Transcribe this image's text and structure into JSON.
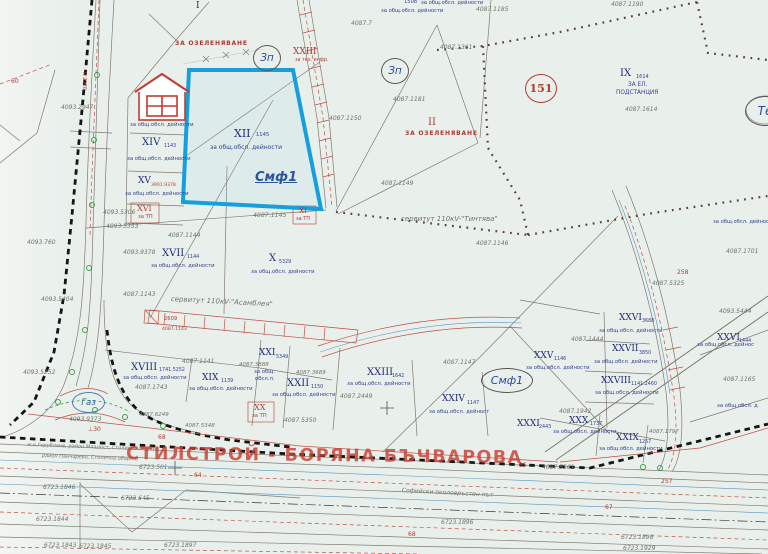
{
  "watermark": "СТИЛСТРОЙ - БОРЯНА БЪЧВАРОВА",
  "zones": {
    "zp1": "Зп",
    "zp2": "Зп",
    "circle151": "151",
    "te": "Те",
    "gas": "Газ",
    "smf1": "Смф1"
  },
  "labels": [
    {
      "t": "I",
      "x": 196,
      "y": 2,
      "c": "br",
      "fs": 9
    },
    {
      "t": "ЗА ОЗЕЛЕНЯВАНЕ",
      "x": 175,
      "y": 41,
      "c": "ri",
      "fs": 6
    },
    {
      "t": "XXIII",
      "x": 293,
      "y": 48,
      "c": "r",
      "fs": 9
    },
    {
      "t": "за тех. инфр.",
      "x": 295,
      "y": 59,
      "c": "rs",
      "fs": 4.8
    },
    {
      "t": "4087.1190",
      "x": 611,
      "y": 2,
      "c": "g",
      "fs": 6
    },
    {
      "t": "1508",
      "x": 404,
      "y": 0,
      "c": "b",
      "fs": 5.2
    },
    {
      "t": "за общ.обсл. дейности",
      "x": 421,
      "y": 1,
      "c": "b",
      "fs": 5.2
    },
    {
      "t": "за общ.обсл. дейности",
      "x": 381,
      "y": 9,
      "c": "b",
      "fs": 5.2
    },
    {
      "t": "4087.1185",
      "x": 476,
      "y": 7,
      "c": "g",
      "fs": 6
    },
    {
      "t": "4087.7",
      "x": 351,
      "y": 21,
      "c": "g",
      "fs": 6
    },
    {
      "t": "4087.1361",
      "x": 440,
      "y": 45,
      "c": "g",
      "fs": 6
    },
    {
      "t": "4087.1181",
      "x": 393,
      "y": 97,
      "c": "g",
      "fs": 6
    },
    {
      "t": "4087.1150",
      "x": 329,
      "y": 116,
      "c": "g",
      "fs": 6
    },
    {
      "t": "4087.1149",
      "x": 381,
      "y": 181,
      "c": "g",
      "fs": 6
    },
    {
      "t": "II",
      "x": 428,
      "y": 118,
      "c": "r",
      "fs": 10
    },
    {
      "t": "ЗА ОЗЕЛЕНЯВАНЕ",
      "x": 405,
      "y": 131,
      "c": "ri",
      "fs": 6
    },
    {
      "t": "IX",
      "x": 620,
      "y": 69,
      "c": "br",
      "fs": 10
    },
    {
      "t": "1614",
      "x": 636,
      "y": 75,
      "c": "bs",
      "fs": 5
    },
    {
      "t": "ЗА ЕЛ.",
      "x": 628,
      "y": 83,
      "c": "b",
      "fs": 5.8
    },
    {
      "t": "ПОДСТАНЦИЯ",
      "x": 616,
      "y": 91,
      "c": "b",
      "fs": 5.8
    },
    {
      "t": "4087.1614",
      "x": 625,
      "y": 107,
      "c": "g",
      "fs": 6
    },
    {
      "t": "за общ.обсл. дейности",
      "x": 130,
      "y": 123,
      "c": "b",
      "fs": 5.3
    },
    {
      "t": "XIV",
      "x": 142,
      "y": 138,
      "c": "br",
      "fs": 10
    },
    {
      "t": "1143",
      "x": 164,
      "y": 145,
      "c": "bs",
      "fs": 4.8
    },
    {
      "t": "за общ.обсл. дейности",
      "x": 127,
      "y": 157,
      "c": "b",
      "fs": 5.3
    },
    {
      "t": "XV",
      "x": 138,
      "y": 177,
      "c": "br",
      "fs": 9
    },
    {
      "t": "3901.9378",
      "x": 151,
      "y": 184,
      "c": "rs",
      "fs": 4.6
    },
    {
      "t": "за общ.обсл. дейности",
      "x": 125,
      "y": 192,
      "c": "b",
      "fs": 5.3
    },
    {
      "t": "XVI",
      "x": 137,
      "y": 205,
      "c": "r",
      "fs": 8
    },
    {
      "t": "за ТП",
      "x": 138,
      "y": 215,
      "c": "rs",
      "fs": 5.2
    },
    {
      "t": "4093.2947",
      "x": 61,
      "y": 105,
      "c": "g",
      "fs": 6
    },
    {
      "t": "R 2000",
      "x": 86,
      "y": 72,
      "c": "rs",
      "fs": 5,
      "rot": 90
    },
    {
      "t": "60",
      "x": 11,
      "y": 79,
      "c": "rs",
      "fs": 6
    },
    {
      "t": "4093.760",
      "x": 27,
      "y": 240,
      "c": "g",
      "fs": 6
    },
    {
      "t": "4093.5306",
      "x": 103,
      "y": 210,
      "c": "g",
      "fs": 6
    },
    {
      "t": "4093.5353",
      "x": 106,
      "y": 224,
      "c": "g",
      "fs": 6
    },
    {
      "t": "4093.9378",
      "x": 123,
      "y": 250,
      "c": "g",
      "fs": 6
    },
    {
      "t": "4093.5404",
      "x": 41,
      "y": 297,
      "c": "g",
      "fs": 6
    },
    {
      "t": "4093.5252",
      "x": 23,
      "y": 370,
      "c": "g",
      "fs": 6
    },
    {
      "t": "4093.9373",
      "x": 69,
      "y": 417,
      "c": "g",
      "fs": 6
    },
    {
      "t": "XII",
      "x": 234,
      "y": 128,
      "c": "br",
      "fs": 11
    },
    {
      "t": "1145",
      "x": 256,
      "y": 133,
      "c": "bs",
      "fs": 5.2
    },
    {
      "t": "за общ.обсл. дейности",
      "x": 210,
      "y": 145,
      "c": "b",
      "fs": 6
    },
    {
      "t": "Смф1",
      "x": 255,
      "y": 171,
      "c": "zb",
      "fs": 13
    },
    {
      "t": "4087.1145",
      "x": 253,
      "y": 213,
      "c": "g",
      "fs": 6.2
    },
    {
      "t": "XI",
      "x": 299,
      "y": 208,
      "c": "r",
      "fs": 7
    },
    {
      "t": "за ТП",
      "x": 296,
      "y": 217,
      "c": "rs",
      "fs": 5
    },
    {
      "t": "4087.1144",
      "x": 168,
      "y": 233,
      "c": "g",
      "fs": 6
    },
    {
      "t": "XVII",
      "x": 162,
      "y": 249,
      "c": "br",
      "fs": 10
    },
    {
      "t": "1144",
      "x": 187,
      "y": 256,
      "c": "bs",
      "fs": 4.8
    },
    {
      "t": "за общ.обсл. дейности",
      "x": 151,
      "y": 264,
      "c": "b",
      "fs": 5.3
    },
    {
      "t": "X",
      "x": 269,
      "y": 254,
      "c": "br",
      "fs": 10
    },
    {
      "t": "5329",
      "x": 279,
      "y": 261,
      "c": "bs",
      "fs": 4.8
    },
    {
      "t": "за общ.обсл. дейности",
      "x": 251,
      "y": 270,
      "c": "b",
      "fs": 5.3
    },
    {
      "t": "4087.1143",
      "x": 123,
      "y": 292,
      "c": "g",
      "fs": 6
    },
    {
      "t": "сервитут 110кV-\"Тинтява\"",
      "x": 401,
      "y": 216,
      "c": "gi",
      "fs": 7
    },
    {
      "t": "4087.1146",
      "x": 476,
      "y": 241,
      "c": "g",
      "fs": 6
    },
    {
      "t": "сервитут 110кV-\"Асамблея\"",
      "x": 171,
      "y": 296,
      "c": "gi",
      "fs": 7,
      "rot": 3
    },
    {
      "t": "2609",
      "x": 164,
      "y": 317,
      "c": "rs",
      "fs": 5.2
    },
    {
      "t": "4087.1143",
      "x": 162,
      "y": 328,
      "c": "rs",
      "fs": 4.6
    },
    {
      "t": "за общ.обсл. дейност",
      "x": 713,
      "y": 220,
      "c": "b",
      "fs": 5.2
    },
    {
      "t": "4087.1701",
      "x": 726,
      "y": 249,
      "c": "g",
      "fs": 6
    },
    {
      "t": "XVIII",
      "x": 131,
      "y": 363,
      "c": "br",
      "fs": 10
    },
    {
      "t": "1741.5252",
      "x": 159,
      "y": 369,
      "c": "bs",
      "fs": 4.8
    },
    {
      "t": "за общ.обсл. дейности",
      "x": 123,
      "y": 376,
      "c": "b",
      "fs": 5.3
    },
    {
      "t": "4087.1743",
      "x": 135,
      "y": 385,
      "c": "g",
      "fs": 6
    },
    {
      "t": "4087.1141",
      "x": 182,
      "y": 359,
      "c": "g",
      "fs": 6
    },
    {
      "t": "XIX",
      "x": 202,
      "y": 374,
      "c": "br",
      "fs": 9
    },
    {
      "t": "1139",
      "x": 221,
      "y": 380,
      "c": "bs",
      "fs": 4.8
    },
    {
      "t": "за общ.обсл. дейности",
      "x": 189,
      "y": 387,
      "c": "b",
      "fs": 5.3
    },
    {
      "t": "XXI",
      "x": 259,
      "y": 349,
      "c": "br",
      "fs": 9
    },
    {
      "t": "5349",
      "x": 276,
      "y": 356,
      "c": "bs",
      "fs": 4.8
    },
    {
      "t": "4087.3888",
      "x": 239,
      "y": 363,
      "c": "g",
      "fs": 5.5
    },
    {
      "t": "за общ.",
      "x": 254,
      "y": 370,
      "c": "b",
      "fs": 5.3
    },
    {
      "t": "обсл.п.",
      "x": 255,
      "y": 377,
      "c": "b",
      "fs": 5.3
    },
    {
      "t": "XX",
      "x": 254,
      "y": 404,
      "c": "r",
      "fs": 8
    },
    {
      "t": "за ТП",
      "x": 252,
      "y": 414,
      "c": "rs",
      "fs": 5.2
    },
    {
      "t": "4087.5350",
      "x": 284,
      "y": 418,
      "c": "g",
      "fs": 6
    },
    {
      "t": "4087.3689",
      "x": 296,
      "y": 371,
      "c": "g",
      "fs": 5.5
    },
    {
      "t": "XXII",
      "x": 287,
      "y": 379,
      "c": "br",
      "fs": 10
    },
    {
      "t": "1150",
      "x": 311,
      "y": 386,
      "c": "bs",
      "fs": 4.8
    },
    {
      "t": "за общ.обсл. дейности",
      "x": 272,
      "y": 393,
      "c": "b",
      "fs": 5.3
    },
    {
      "t": "XXIII",
      "x": 367,
      "y": 368,
      "c": "br",
      "fs": 10
    },
    {
      "t": "1642",
      "x": 392,
      "y": 375,
      "c": "bs",
      "fs": 4.8
    },
    {
      "t": "за общ.обсл. дейности",
      "x": 347,
      "y": 382,
      "c": "b",
      "fs": 5.3
    },
    {
      "t": "4087.2449",
      "x": 340,
      "y": 394,
      "c": "g",
      "fs": 6
    },
    {
      "t": "4087.1147",
      "x": 443,
      "y": 360,
      "c": "g",
      "fs": 6
    },
    {
      "t": "XXIV",
      "x": 442,
      "y": 395,
      "c": "br",
      "fs": 9
    },
    {
      "t": "1147",
      "x": 467,
      "y": 402,
      "c": "bs",
      "fs": 4.8
    },
    {
      "t": "за общ.обсл. дейност",
      "x": 429,
      "y": 410,
      "c": "b",
      "fs": 5.3
    },
    {
      "t": "4087.5325",
      "x": 652,
      "y": 281,
      "c": "g",
      "fs": 6
    },
    {
      "t": "258",
      "x": 677,
      "y": 270,
      "c": "rs",
      "fs": 6
    },
    {
      "t": "4093.5444",
      "x": 719,
      "y": 309,
      "c": "g",
      "fs": 6
    },
    {
      "t": "XXVI",
      "x": 619,
      "y": 314,
      "c": "br",
      "fs": 9
    },
    {
      "t": "3688",
      "x": 642,
      "y": 320,
      "c": "bs",
      "fs": 4.8
    },
    {
      "t": "за общ.обсл. дейности",
      "x": 599,
      "y": 329,
      "c": "b",
      "fs": 5.3
    },
    {
      "t": "4087.1444",
      "x": 571,
      "y": 337,
      "c": "g",
      "fs": 6
    },
    {
      "t": "XXVII",
      "x": 612,
      "y": 345,
      "c": "br",
      "fs": 9
    },
    {
      "t": "3850",
      "x": 639,
      "y": 352,
      "c": "bs",
      "fs": 4.8
    },
    {
      "t": "за общ.обсл. дейности",
      "x": 594,
      "y": 360,
      "c": "b",
      "fs": 5.3
    },
    {
      "t": "XXVIII",
      "x": 601,
      "y": 377,
      "c": "br",
      "fs": 9
    },
    {
      "t": "1141.2460",
      "x": 631,
      "y": 383,
      "c": "bs",
      "fs": 4.8
    },
    {
      "t": "за общ.обсл. дейности",
      "x": 595,
      "y": 391,
      "c": "b",
      "fs": 5.3
    },
    {
      "t": "XXV",
      "x": 534,
      "y": 352,
      "c": "br",
      "fs": 9
    },
    {
      "t": "1146",
      "x": 554,
      "y": 358,
      "c": "bs",
      "fs": 4.8
    },
    {
      "t": "за общ.обсл. дейности",
      "x": 526,
      "y": 366,
      "c": "b",
      "fs": 5.3
    },
    {
      "t": "XXVI",
      "x": 717,
      "y": 334,
      "c": "br",
      "fs": 9
    },
    {
      "t": "1444",
      "x": 739,
      "y": 340,
      "c": "bs",
      "fs": 4.8
    },
    {
      "t": "за общ.обсл. дейнос",
      "x": 697,
      "y": 343,
      "c": "b",
      "fs": 5.3
    },
    {
      "t": "4087.1165",
      "x": 723,
      "y": 377,
      "c": "g",
      "fs": 6
    },
    {
      "t": "за общ.обсл. д",
      "x": 717,
      "y": 404,
      "c": "b",
      "fs": 5.3
    },
    {
      "t": "4087.1942",
      "x": 559,
      "y": 409,
      "c": "g",
      "fs": 6
    },
    {
      "t": "XXX",
      "x": 569,
      "y": 417,
      "c": "br",
      "fs": 9
    },
    {
      "t": "1737",
      "x": 590,
      "y": 423,
      "c": "bs",
      "fs": 4.8
    },
    {
      "t": "2443",
      "x": 539,
      "y": 426,
      "c": "bs",
      "fs": 4.8
    },
    {
      "t": "за общ.обсл. дейности",
      "x": 553,
      "y": 430,
      "c": "b",
      "fs": 5.3
    },
    {
      "t": "XXXI",
      "x": 517,
      "y": 420,
      "c": "br",
      "fs": 9
    },
    {
      "t": "XXIX",
      "x": 616,
      "y": 434,
      "c": "br",
      "fs": 9
    },
    {
      "t": "1257",
      "x": 639,
      "y": 441,
      "c": "bs",
      "fs": 4.8
    },
    {
      "t": "за общ.обсл. дейности",
      "x": 599,
      "y": 447,
      "c": "b",
      "fs": 5.3
    },
    {
      "t": "4087.1797",
      "x": 649,
      "y": 430,
      "c": "g",
      "fs": 5.5
    },
    {
      "t": "4087.5361",
      "x": 542,
      "y": 465,
      "c": "g",
      "fs": 6
    },
    {
      "t": "257",
      "x": 661,
      "y": 479,
      "c": "rs",
      "fs": 6
    },
    {
      "t": "67",
      "x": 605,
      "y": 505,
      "c": "rs",
      "fs": 6
    },
    {
      "t": "6723.1898",
      "x": 621,
      "y": 535,
      "c": "g",
      "fs": 6
    },
    {
      "t": "6723.1929",
      "x": 623,
      "y": 546,
      "c": "g",
      "fs": 6
    },
    {
      "t": "⊥30",
      "x": 88,
      "y": 427,
      "c": "rs",
      "fs": 6
    },
    {
      "t": "68",
      "x": 158,
      "y": 435,
      "c": "rs",
      "fs": 6
    },
    {
      "t": "4087.6249",
      "x": 139,
      "y": 413,
      "c": "g",
      "fs": 5.5
    },
    {
      "t": "4087.5348",
      "x": 185,
      "y": 424,
      "c": "g",
      "fs": 5.5
    },
    {
      "t": "ж.к.Горубляне, район Младост, Столична община",
      "x": 27,
      "y": 443,
      "c": "gi",
      "fs": 5,
      "rot": 2
    },
    {
      "t": "район Панчарево, Столична община",
      "x": 42,
      "y": 454,
      "c": "gi",
      "fs": 5,
      "rot": 2
    },
    {
      "t": "6723.501",
      "x": 139,
      "y": 465,
      "c": "g",
      "fs": 6
    },
    {
      "t": "64",
      "x": 194,
      "y": 473,
      "c": "rs",
      "fs": 6
    },
    {
      "t": "6723.1846",
      "x": 43,
      "y": 485,
      "c": "g",
      "fs": 6
    },
    {
      "t": "6723.645",
      "x": 121,
      "y": 496,
      "c": "g",
      "fs": 6
    },
    {
      "t": "6723.1844",
      "x": 36,
      "y": 517,
      "c": "g",
      "fs": 6
    },
    {
      "t": "6723.1843",
      "x": 44,
      "y": 543,
      "c": "g",
      "fs": 6
    },
    {
      "t": "6723.1845",
      "x": 79,
      "y": 544,
      "c": "g",
      "fs": 6
    },
    {
      "t": "6723.1897",
      "x": 164,
      "y": 543,
      "c": "g",
      "fs": 6
    },
    {
      "t": "Софийски околовръстен път",
      "x": 402,
      "y": 488,
      "c": "gi",
      "fs": 6,
      "rot": 3
    },
    {
      "t": "85",
      "x": 519,
      "y": 463,
      "c": "rs",
      "fs": 6
    },
    {
      "t": "68",
      "x": 408,
      "y": 532,
      "c": "rs",
      "fs": 6
    },
    {
      "t": "6723.1896",
      "x": 441,
      "y": 520,
      "c": "g",
      "fs": 6
    }
  ]
}
